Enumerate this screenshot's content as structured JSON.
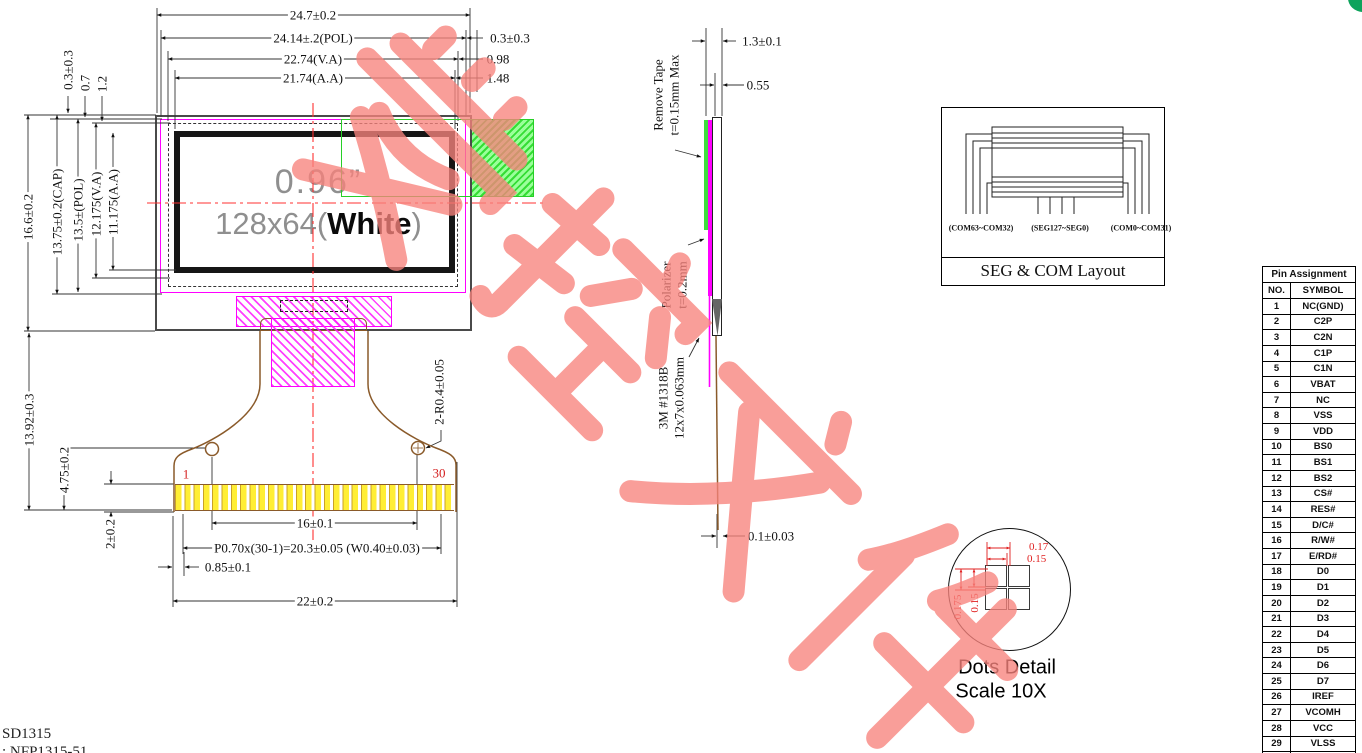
{
  "watermark": {
    "text": "受控文件",
    "color": "#f8837d"
  },
  "front_view": {
    "display": {
      "size_label": "0.96”",
      "res_prefix": "128x64(",
      "res_word": "White",
      "res_suffix": ")"
    },
    "pin_first": "1",
    "pin_last": "30"
  },
  "dims": {
    "top": [
      "24.7±0.2",
      "24.14±.2(POL)",
      "22.74(V.A)",
      "21.74(A.A)"
    ],
    "top_right": [
      "0.3±0.3",
      "0.98",
      "1.48"
    ],
    "left_top": [
      "0.3±0.3",
      "0.7",
      "1.2"
    ],
    "left": [
      "16.6±0.2",
      "13.75±0.2(CAP)",
      "13.5±(POL)",
      "12.175(V.A)",
      "11.175(A.A)"
    ],
    "left_bottom": [
      "13.92±0.3",
      "4.75±0.2",
      "2±0.2"
    ],
    "bottom": [
      "16±0.1",
      "P0.70x(30-1)=20.3±0.05 (W0.40±0.03)",
      "0.85±0.1",
      "22±0.2"
    ],
    "fpc_radius": "2-R0.4±0.05"
  },
  "side_view": {
    "dim_total": "1.3±0.1",
    "dim_glass": "0.55",
    "dim_fpc": "0.1±0.03",
    "remove_tape_l1": "Remove Tape",
    "remove_tape_l2": "t=0.15mm Max",
    "polarizer_l1": "Polarizer",
    "polarizer_l2": "t=0.2mm",
    "adhesive_l1": "3M #1318B",
    "adhesive_l2": "12x7x0.063mm"
  },
  "seg_com": {
    "labels": [
      "(COM63~COM32)",
      "(SEG127~SEG0)",
      "(COM0~COM31)"
    ],
    "caption": "SEG & COM Layout"
  },
  "dots_detail": {
    "dim_h1": "0.17",
    "dim_h2": "0.15",
    "dim_v1": "0.15",
    "dim_v2": "0.175",
    "caption_l1": "Dots Detail",
    "caption_l2": "Scale 10X"
  },
  "pin_table": {
    "title": "Pin Assignment",
    "col_no": "NO.",
    "col_symbol": "SYMBOL",
    "rows": [
      {
        "no": "1",
        "symbol": "NC(GND)"
      },
      {
        "no": "2",
        "symbol": "C2P"
      },
      {
        "no": "3",
        "symbol": "C2N"
      },
      {
        "no": "4",
        "symbol": "C1P"
      },
      {
        "no": "5",
        "symbol": "C1N"
      },
      {
        "no": "6",
        "symbol": "VBAT"
      },
      {
        "no": "7",
        "symbol": "NC"
      },
      {
        "no": "8",
        "symbol": "VSS"
      },
      {
        "no": "9",
        "symbol": "VDD"
      },
      {
        "no": "10",
        "symbol": "BS0"
      },
      {
        "no": "11",
        "symbol": "BS1"
      },
      {
        "no": "12",
        "symbol": "BS2"
      },
      {
        "no": "13",
        "symbol": "CS#"
      },
      {
        "no": "14",
        "symbol": "RES#"
      },
      {
        "no": "15",
        "symbol": "D/C#"
      },
      {
        "no": "16",
        "symbol": "R/W#"
      },
      {
        "no": "17",
        "symbol": "E/RD#"
      },
      {
        "no": "18",
        "symbol": "D0"
      },
      {
        "no": "19",
        "symbol": "D1"
      },
      {
        "no": "20",
        "symbol": "D2"
      },
      {
        "no": "21",
        "symbol": "D3"
      },
      {
        "no": "22",
        "symbol": "D4"
      },
      {
        "no": "23",
        "symbol": "D5"
      },
      {
        "no": "24",
        "symbol": "D6"
      },
      {
        "no": "25",
        "symbol": "D7"
      },
      {
        "no": "26",
        "symbol": "IREF"
      },
      {
        "no": "27",
        "symbol": "VCOMH"
      },
      {
        "no": "28",
        "symbol": "VCC"
      },
      {
        "no": "29",
        "symbol": "VLSS"
      },
      {
        "no": "30",
        "symbol": "NC(GND)"
      }
    ]
  },
  "footer": {
    "line1": "SD1315",
    "line2": ": NFP1315-51"
  }
}
